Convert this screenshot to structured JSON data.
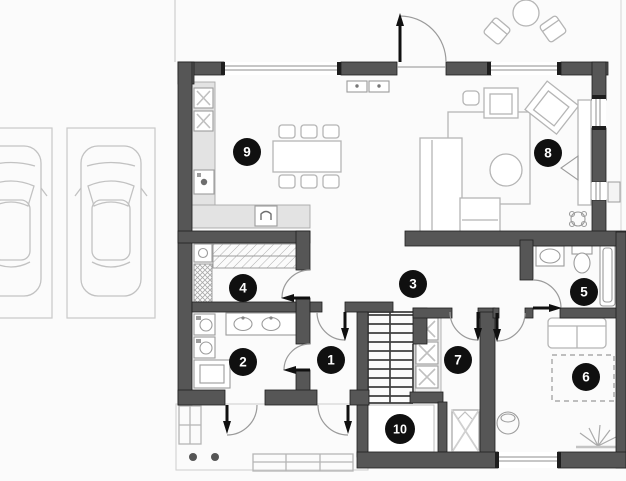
{
  "floor_plan": {
    "room_markers": [
      {
        "label": "1"
      },
      {
        "label": "2"
      },
      {
        "label": "3"
      },
      {
        "label": "4"
      },
      {
        "label": "5"
      },
      {
        "label": "6"
      },
      {
        "label": "7"
      },
      {
        "label": "8"
      },
      {
        "label": "9"
      },
      {
        "label": "10"
      }
    ],
    "symbols": [
      "car-top-view",
      "parking-space",
      "dining-table",
      "chair",
      "corner-sofa",
      "armchair",
      "coffee-table",
      "rug",
      "tv-console",
      "stairs",
      "stove-burner",
      "kitchen-sink",
      "washing-machine",
      "vanity-basin",
      "toilet",
      "bathtub",
      "shower",
      "plant",
      "radiator",
      "ac-unit",
      "door-swing",
      "entrance-door",
      "bench",
      "bed-dashed-outline"
    ]
  },
  "colors": {
    "wall": "#565656",
    "wall_edge": "#1e1e1e",
    "marker_bg": "#101010",
    "marker_text": "#ffffff",
    "furniture_line": "#b5b5b5",
    "fixture_line": "#9c9c9c",
    "counter_fill": "#e3e3e3",
    "door_leaf": "#101010",
    "arc_line": "#9a9a9a",
    "site_line": "#cfcfcf",
    "background": "#fbfbfb",
    "stairs_line": "#3f3f3f"
  }
}
